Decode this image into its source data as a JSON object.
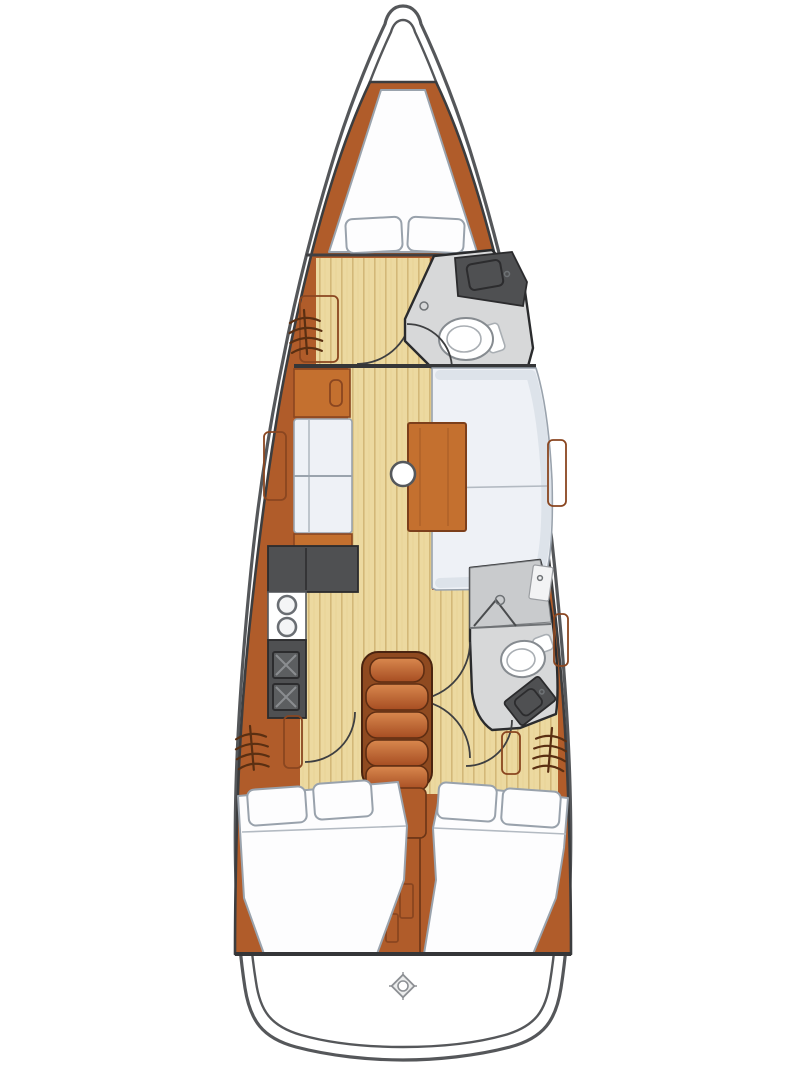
{
  "diagram": {
    "type": "yacht-interior-floor-plan",
    "orientation": "bow-up",
    "title": "Sailboat interior layout plan",
    "rooms": [
      {
        "name": "forward-v-berth-cabin",
        "furniture": [
          "v-berth-double-mattress",
          "pillow",
          "pillow",
          "hanging-locker",
          "cabin-door"
        ]
      },
      {
        "name": "forward-head",
        "furniture": [
          "sink-vanity",
          "toilet",
          "shower-drain",
          "head-door"
        ]
      },
      {
        "name": "salon",
        "furniture": [
          "port-cabinet",
          "two-facing-seats",
          "u-shaped-settee",
          "wooden-table",
          "mast-post"
        ]
      },
      {
        "name": "galley",
        "furniture": [
          "l-shaped-counter",
          "two-burner-stove",
          "double-sink"
        ]
      },
      {
        "name": "companionway",
        "furniture": [
          "steps",
          "engine-box"
        ]
      },
      {
        "name": "aft-head",
        "furniture": [
          "shower-stall",
          "sink-counter",
          "toilet",
          "sink-vanity",
          "head-door"
        ]
      },
      {
        "name": "aft-cabin-port",
        "furniture": [
          "double-berth",
          "pillow",
          "pillow",
          "hanging-locker",
          "cabin-door"
        ]
      },
      {
        "name": "aft-cabin-starboard",
        "furniture": [
          "double-berth",
          "pillow",
          "pillow",
          "hanging-locker",
          "cabin-door"
        ]
      },
      {
        "name": "stern-deck",
        "furniture": [
          "helm-compass-marker"
        ]
      }
    ],
    "icons": [
      "hanger-icon",
      "faucet-icon",
      "burner-icon",
      "drain-icon",
      "compass-icon",
      "door-swing-arc"
    ]
  },
  "colors": {
    "hull-line": "#55575a",
    "wood": "#b05c2a",
    "wood-dark": "#8a4620",
    "wood-light": "#c4702f",
    "floor": "#ecd9a0",
    "floor-line": "#d3b878",
    "cushion": "#eef1f6",
    "cushion-shade": "#dde3ea",
    "cushion-line": "#9aa3ad",
    "counter-dark": "#4f5052",
    "head-floor": "#d7d8d9",
    "head-wall": "#c9cbcd",
    "bg": "#ffffff"
  }
}
